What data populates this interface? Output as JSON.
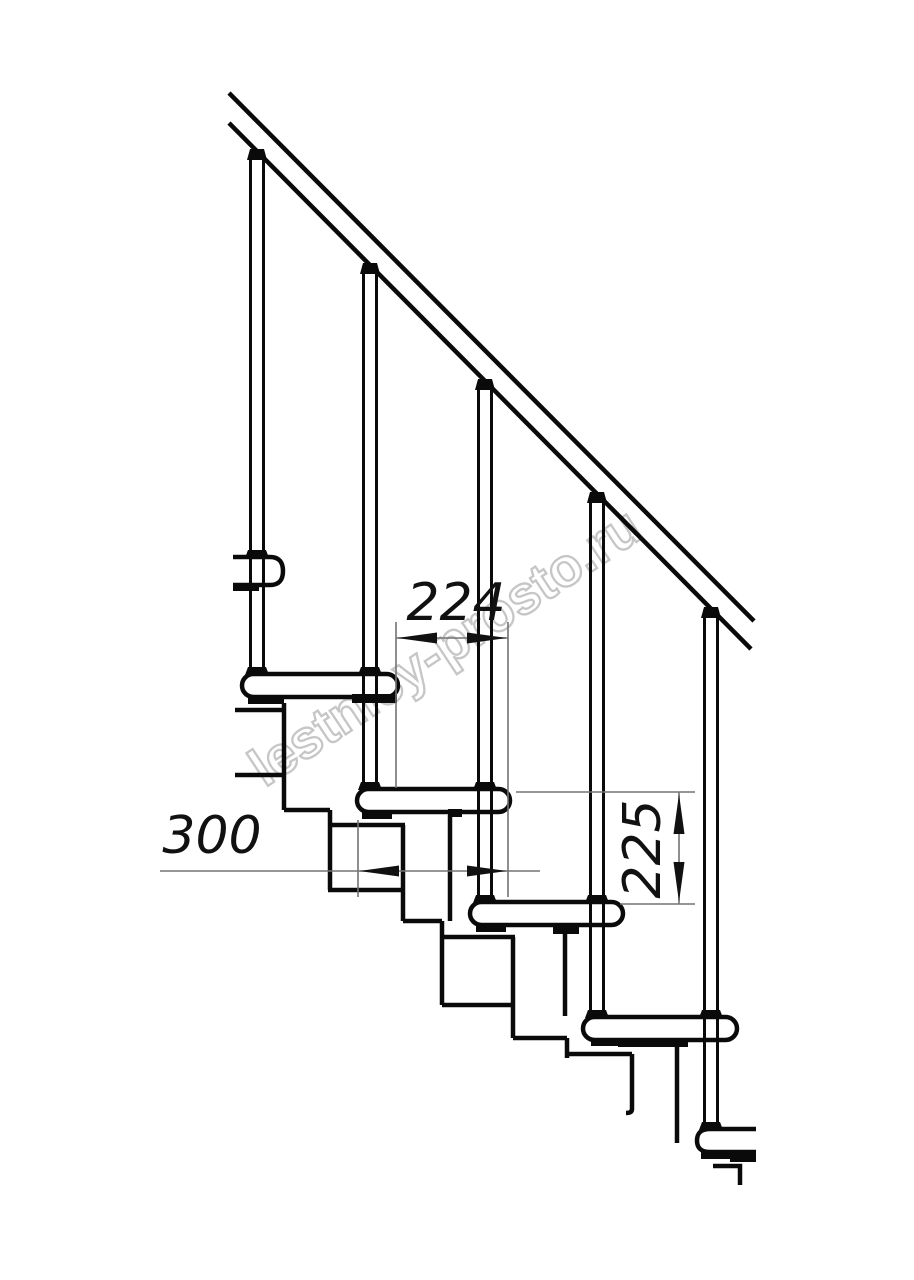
{
  "canvas": {
    "background": "#ffffff"
  },
  "watermark": {
    "text": "lestnicy-prosto.ru",
    "color": "#c6c6c6"
  },
  "drawing": {
    "type": "technical line drawing",
    "subject": "modular staircase side elevation with railing",
    "line_color": "#0a0a0a",
    "thin_line_color": "#737373"
  },
  "dimensions": {
    "run": {
      "value": "224",
      "orientation": "horizontal"
    },
    "depth": {
      "value": "300",
      "orientation": "horizontal"
    },
    "rise": {
      "value": "225",
      "orientation": "vertical"
    }
  }
}
